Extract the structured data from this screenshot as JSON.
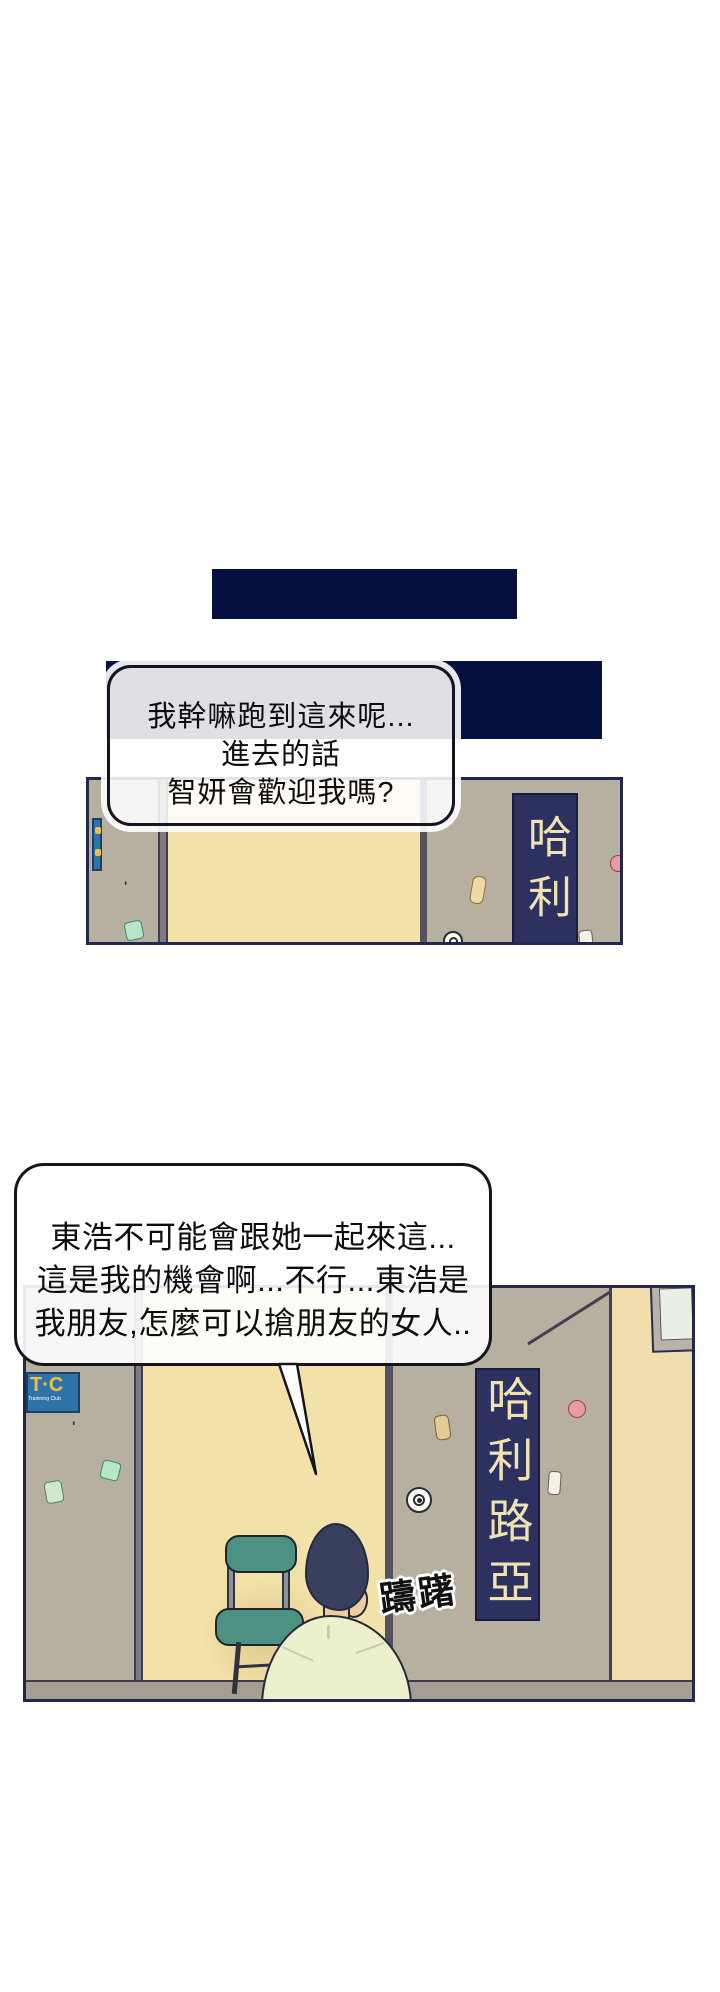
{
  "bubble1": {
    "lines": [
      "我幹嘛跑到這來呢...",
      "進去的話",
      "智妍會歡迎我嗎?"
    ]
  },
  "bubble2": {
    "lines": [
      "東浩不可能會跟她一起來這...",
      "這是我的機會啊...不行...東浩是",
      "我朋友,怎麼可以搶朋友的女人.."
    ]
  },
  "panel1": {
    "door_sign": "哈利"
  },
  "panel2": {
    "door_sign": "哈利路亞",
    "sfx": "躊躇",
    "tc_sign": {
      "title": "T·C",
      "subtitle": "Trainning Club"
    }
  },
  "colors": {
    "navy_bar": "#05103f",
    "panel_border": "#23264d",
    "wall_gray": "#b7afa0",
    "door_cream": "#f3e1aa",
    "right_wall_cream": "#f0dfad",
    "sign_navy": "#2c3160",
    "sign_text_cream": "#f1e2b3",
    "tc_blue": "#2e74a8",
    "tc_yellow": "#f0c03c",
    "chair_teal": "#4d9183",
    "shirt": "#edf0cd",
    "hair": "#39405e",
    "skin": "#eecd9d",
    "floor": "#a69e94"
  }
}
